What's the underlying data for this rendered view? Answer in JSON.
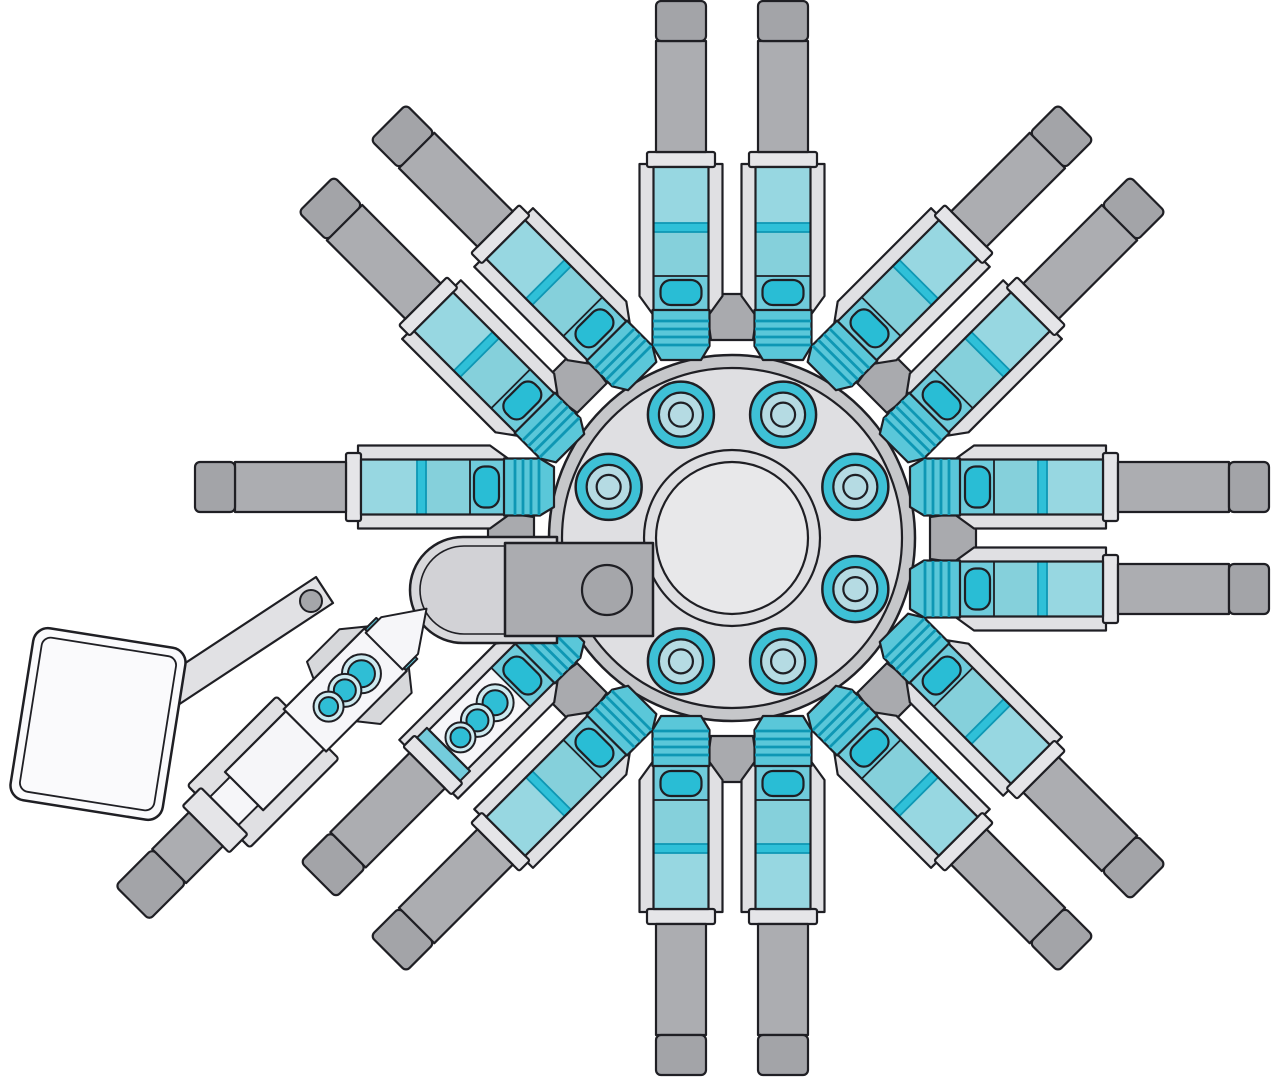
{
  "diagram": {
    "canvas": {
      "width": 1271,
      "height": 1080,
      "background": "#FFFFFF"
    },
    "palette": {
      "outline": "#1F1F24",
      "plate": "#E0E0E3",
      "collar": "#E5E5E8",
      "shaft": "#ACADB1",
      "cap": "#A3A4A8",
      "tab": "#A9AAAE",
      "flange_rim": "#C6C7CA",
      "flange_face": "#DFDFE2",
      "flange_inner": "#E8E8EA",
      "boss_teal": "#3EC1D6",
      "boss_pale": "#B5DBE3",
      "nose_teal": "#5AC7D9",
      "stripe_teal": "#0E97B4",
      "body_seg1": "#6FCBDB",
      "body_seg2": "#85D0DB",
      "body_band": "#2FC0D8",
      "body_seg3": "#97D7E1",
      "pill_teal": "#29BDD5",
      "teal_collar": "#74CCDC",
      "white_body": "#F6F6F9",
      "socket_pale": "#CDEAF0",
      "socket_teal": "#2FBED5",
      "capsule_outer": "#D9D9DC",
      "capsule_inner": "#D2D2D6",
      "block_gray": "#ABACB0",
      "hole_gray": "#A5A6AA",
      "cowl_gray": "#D7D8DB",
      "lever_gray": "#E1E1E4",
      "tank_white": "#FAFAFC"
    },
    "hub": {
      "cx": 732,
      "cy": 538,
      "rim_radius": 183,
      "face_radius": 170,
      "center_ring_radii": [
        88,
        76
      ],
      "bolt_circle_radius": 133.5,
      "bolt_count": 8,
      "bolt_start_angle_deg": 22.5,
      "boss_ring_radii": [
        33,
        22,
        12
      ]
    },
    "tabs": {
      "angles_deg": [
        0,
        45,
        90,
        135,
        180,
        225,
        270,
        315
      ]
    },
    "arms": {
      "pair_offset_px": 51,
      "list": [
        {
          "angle": 270,
          "offset": -51,
          "type": "standard"
        },
        {
          "angle": 270,
          "offset": 51,
          "type": "standard"
        },
        {
          "angle": 315,
          "offset": -51,
          "type": "standard"
        },
        {
          "angle": 315,
          "offset": 51,
          "type": "standard"
        },
        {
          "angle": 0,
          "offset": -51,
          "type": "standard"
        },
        {
          "angle": 0,
          "offset": 51,
          "type": "standard"
        },
        {
          "angle": 45,
          "offset": -51,
          "type": "standard"
        },
        {
          "angle": 45,
          "offset": 51,
          "type": "standard"
        },
        {
          "angle": 90,
          "offset": -51,
          "type": "standard"
        },
        {
          "angle": 90,
          "offset": 51,
          "type": "standard"
        },
        {
          "angle": 135,
          "offset": -51,
          "type": "standard"
        },
        {
          "angle": 135,
          "offset": 51,
          "type": "socket_insert"
        },
        {
          "angle": 180,
          "offset": 51,
          "type": "standard"
        },
        {
          "angle": 225,
          "offset": -51,
          "type": "standard"
        },
        {
          "angle": 225,
          "offset": 51,
          "type": "standard"
        }
      ],
      "socket_insert_circle_positions": [
        284,
        309,
        333
      ],
      "socket_insert_circle_outer_radii": [
        18.5,
        16.5,
        15
      ],
      "socket_insert_circle_inner_radii": [
        12.5,
        11,
        10
      ]
    },
    "clevis": {
      "capsule": {
        "x_right": 557,
        "y_top": 537,
        "y_bottom": 643,
        "end_cx": 463,
        "end_r": 53,
        "inner_inset": 9
      },
      "block": {
        "x": 505,
        "y": 543,
        "w": 148,
        "h": 93
      },
      "pin_hole": {
        "cx": 607,
        "cy": 590,
        "r": 25
      }
    },
    "pump": {
      "origin": {
        "x": 614.6,
        "y": 420.6
      },
      "rotation_deg": 135,
      "socket_circle_positions": [
        358,
        381.5,
        404.5
      ],
      "socket_circle_outer_radii": [
        19.5,
        16.5,
        15
      ],
      "socket_circle_inner_radii": [
        13.5,
        11,
        9.5
      ],
      "lever": {
        "points": "158,681 316,577 333,603 175,707",
        "hole": {
          "cx": 311,
          "cy": 601,
          "r": 11
        }
      },
      "tank": {
        "cx": 98,
        "cy": 724,
        "rotation_deg": 9,
        "w": 154,
        "h": 174,
        "corner_r": 15,
        "inner_inset": 9
      }
    }
  }
}
